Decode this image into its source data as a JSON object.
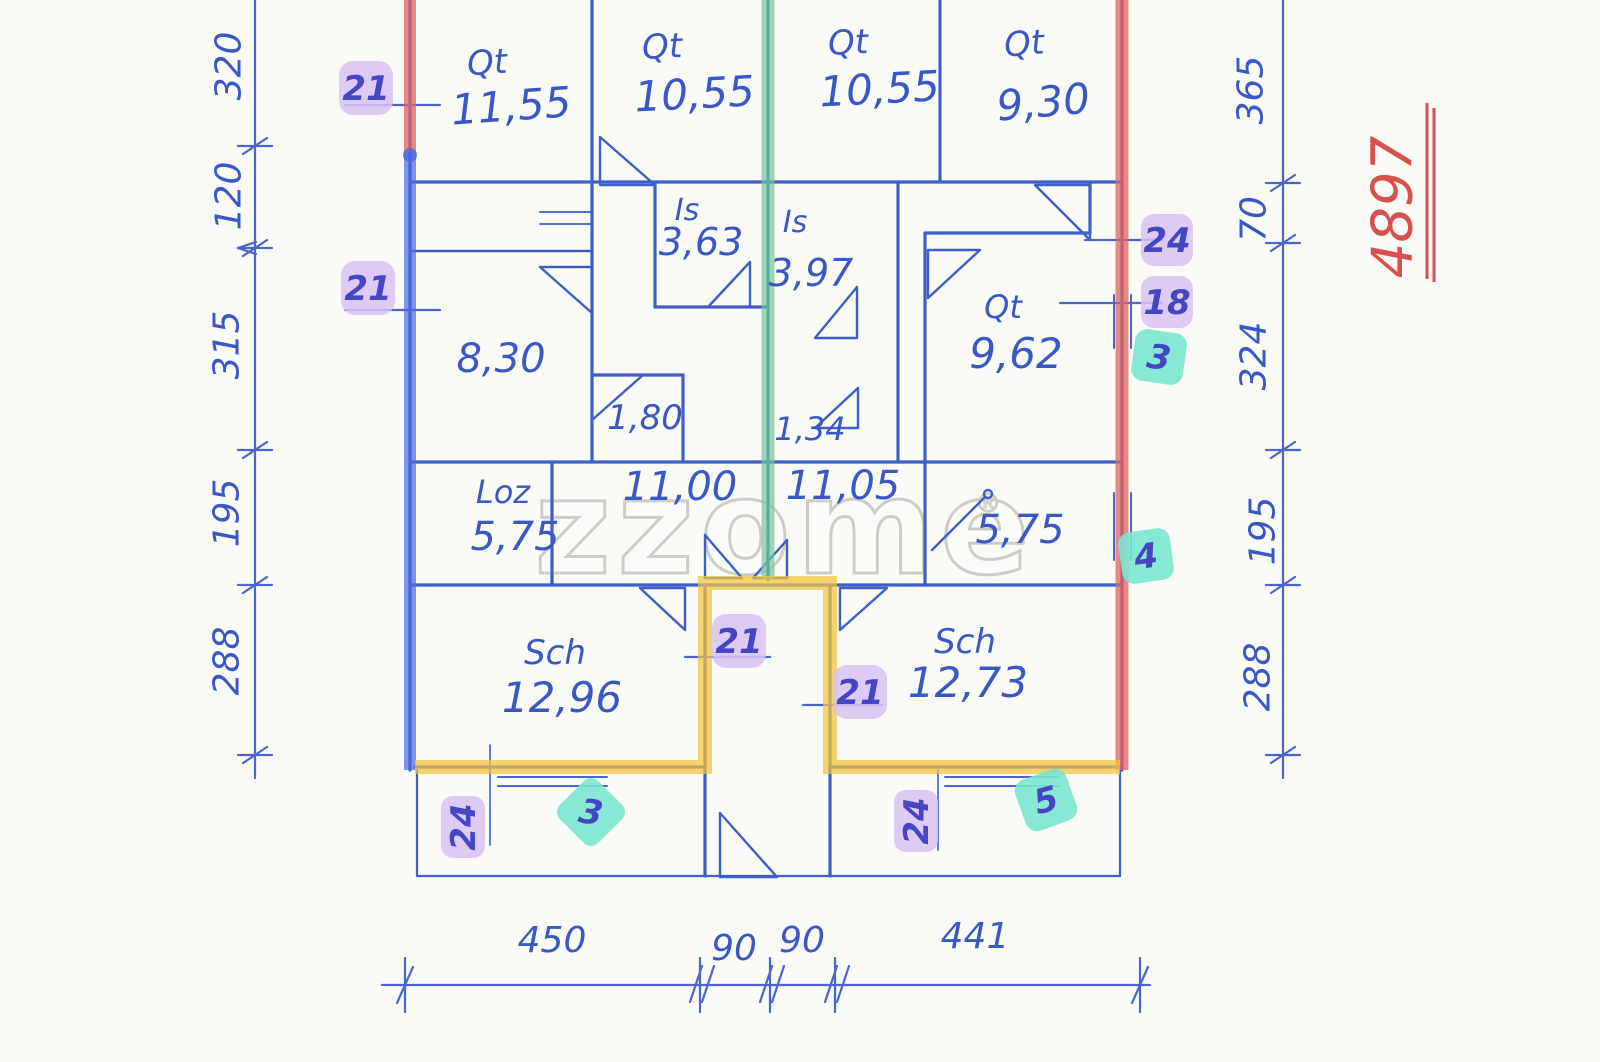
{
  "watermark": {
    "text": "zzome",
    "mark": "®"
  },
  "annotation": {
    "red_number": "4897"
  },
  "colors": {
    "ink_blue": "#3f5ec8",
    "highlight_red": "#e0635c",
    "highlight_blue": "#4a6ae2",
    "highlight_green": "#72c795",
    "highlight_yellow": "#f2c33d",
    "badge_purple": "#d8c2f2",
    "badge_teal": "#7ae5cf",
    "red_note": "#d8504b",
    "paper": "#fafaf7"
  },
  "rooms": {
    "qt_top_1": {
      "label": "Qt",
      "area": "11,55"
    },
    "qt_top_2": {
      "label": "Qt",
      "area": "10,55"
    },
    "qt_top_3": {
      "label": "Qt",
      "area": "10,55"
    },
    "qt_top_4": {
      "label": "Qt",
      "area": "9,30"
    },
    "is_1": {
      "label": "Is",
      "area": "3,63"
    },
    "is_2": {
      "label": "Is",
      "area": "3,97"
    },
    "r_830": {
      "area": "8,30"
    },
    "r_180": {
      "area": "1,80"
    },
    "r_134": {
      "area": "1,34"
    },
    "qt_962": {
      "label": "Qt",
      "area": "9,62"
    },
    "loz": {
      "label": "Loz",
      "area": "5,75"
    },
    "hall_left": {
      "area": "11,00"
    },
    "hall_right": {
      "area": "11,05"
    },
    "r_575": {
      "area": "5,75"
    },
    "sch_left": {
      "label": "Sch",
      "area": "12,96"
    },
    "sch_right": {
      "label": "Sch",
      "area": "12,73"
    }
  },
  "dims": {
    "left_320": "320",
    "left_120": "120",
    "left_315": "315",
    "left_195": "195",
    "left_288": "288",
    "right_365": "365",
    "right_70": "70",
    "right_324": "324",
    "right_195": "195",
    "right_288": "288",
    "bottom_450": "450",
    "bottom_90a": "90",
    "bottom_90b": "90",
    "bottom_441": "441"
  },
  "badges": {
    "purple_left_top": "21",
    "purple_left_mid": "21",
    "purple_right_24": "24",
    "purple_right_18": "18",
    "purple_vest_left": "21",
    "purple_vest_right": "21",
    "purple_terrace_left": "24",
    "purple_terrace_right": "24",
    "teal_right_upper": "3",
    "teal_right_lower": "4",
    "teal_terrace_left": "3",
    "teal_terrace_right": "5"
  }
}
